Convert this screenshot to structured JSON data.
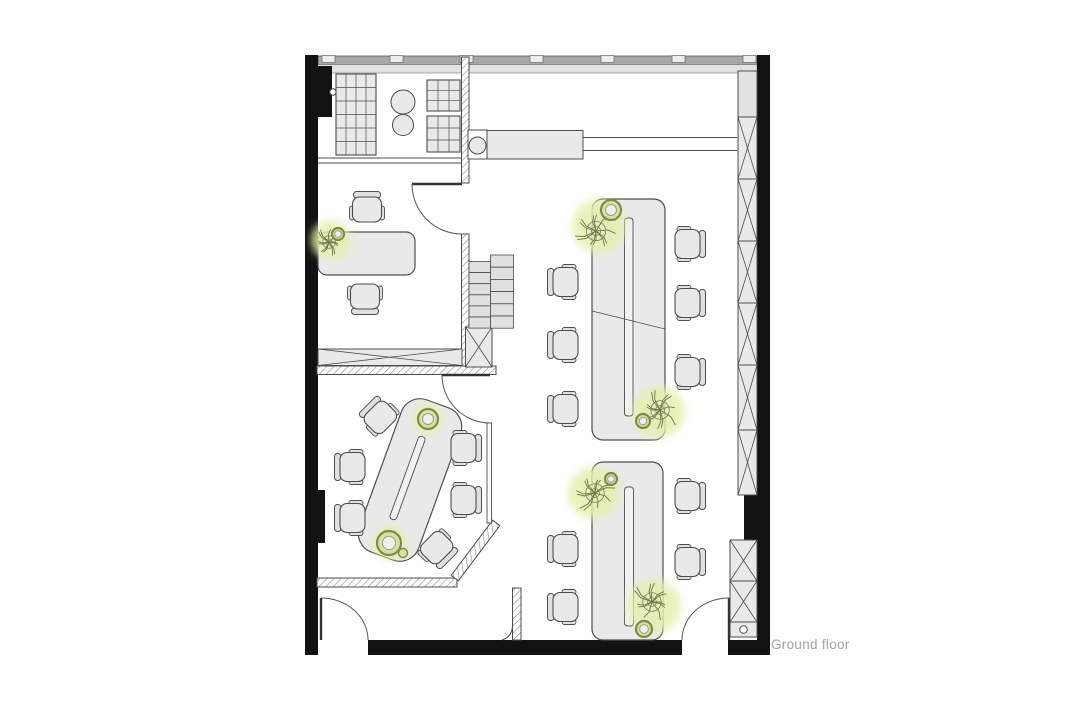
{
  "title": {
    "label": "Ground floor"
  },
  "colors": {
    "wall": "#121212",
    "stroke": "#4d4d4d",
    "furn": "#e9e9e9",
    "furn2": "#e0e0e0",
    "white": "#ffffff",
    "band_outer": "#a8a8a8",
    "band_inner": "#e2e2e2",
    "mullion": "#ececec",
    "hatch": "#8c8c8c",
    "glow": "#e4efad",
    "branch": "#6b7446",
    "pot_ring": "#7d8b49",
    "pot_fill": "#d7e39b",
    "pot_inner": "#f0efec",
    "label": "#a3a3a3"
  },
  "floorplan": {
    "window_band": {
      "outer": {
        "x": 318,
        "y": 56,
        "w": 439,
        "h": 8.5
      },
      "inner": {
        "x": 318,
        "y": 64.5,
        "w": 439,
        "h": 8.5
      },
      "mullions": [
        322,
        390,
        460,
        530,
        601,
        672,
        743
      ],
      "mullion_w": 13,
      "mullion_h": 7
    },
    "black_walls": [
      {
        "name": "wall-left",
        "x": 305,
        "y": 55,
        "w": 13,
        "h": 600
      },
      {
        "name": "wall-right",
        "x": 757,
        "y": 55,
        "w": 13,
        "h": 600
      },
      {
        "name": "wall-bottom-main",
        "x": 368,
        "y": 640,
        "w": 314,
        "h": 15
      },
      {
        "name": "wall-bottom-right",
        "x": 728,
        "y": 640,
        "w": 42,
        "h": 15
      },
      {
        "name": "column-top-left",
        "x": 316,
        "y": 66,
        "w": 16,
        "h": 51
      },
      {
        "name": "pier-left",
        "x": 305,
        "y": 490,
        "w": 20,
        "h": 53
      },
      {
        "name": "pier-right",
        "x": 744,
        "y": 495,
        "w": 26,
        "h": 45
      }
    ],
    "hatched_walls": [
      {
        "name": "wall-kitchen-partition",
        "x": 461.5,
        "y": 57,
        "w": 7.5,
        "h": 126
      },
      {
        "name": "wall-office-partition",
        "x": 461.5,
        "y": 234,
        "w": 7.5,
        "h": 140
      },
      {
        "name": "wall-office-bottom",
        "x": 317,
        "y": 366,
        "w": 179,
        "h": 8.5
      },
      {
        "name": "wall-meeting-bottom",
        "x": 317,
        "y": 578,
        "w": 140,
        "h": 9
      },
      {
        "name": "wall-meeting-chamfer",
        "x": 441,
        "y": 546,
        "w": 69,
        "h": 9,
        "rot": -53,
        "cx": 475.5,
        "cy": 550.5
      },
      {
        "name": "wall-entry-stub",
        "x": 512.5,
        "y": 588,
        "w": 8.5,
        "h": 52
      }
    ],
    "wall_paths": [
      {
        "name": "stub-foot-curve",
        "d": "M502,640 Q512,637 512.5,626"
      }
    ],
    "thin_walls": [
      {
        "name": "glass-partition",
        "x": 487,
        "y": 423,
        "w": 4.5,
        "h": 100
      }
    ],
    "xboxes": [
      {
        "name": "credenza",
        "x": 318,
        "y": 349,
        "w": 144,
        "h": 16.5
      },
      {
        "name": "shaft",
        "x": 465.5,
        "y": 327,
        "w": 26.5,
        "h": 40
      }
    ],
    "lattices": [
      {
        "name": "lattice-right-upper",
        "x": 738,
        "w": 19,
        "bounds": [
          117,
          179,
          241,
          303,
          365,
          430,
          495
        ]
      },
      {
        "name": "lattice-right-lower",
        "x": 730,
        "w": 27,
        "bounds": [
          540,
          581,
          622
        ]
      }
    ],
    "plain_rects": [
      {
        "name": "lattice-cap",
        "x": 738,
        "y": 71,
        "w": 19,
        "h": 46,
        "fill": "band_inner"
      },
      {
        "name": "drawer-box",
        "x": 730,
        "y": 622,
        "w": 27,
        "h": 15,
        "fill": "furn"
      },
      {
        "name": "counter-box",
        "x": 468,
        "y": 130,
        "w": 19,
        "h": 29,
        "fill": "white"
      },
      {
        "name": "counter",
        "x": 487,
        "y": 130.5,
        "w": 96,
        "h": 28.5,
        "fill": "furn"
      }
    ],
    "circles": [
      {
        "name": "counter-basin",
        "c": [
          477.5,
          145.5
        ],
        "r": 8.5,
        "fill": "furn"
      },
      {
        "name": "kitchen-stool-1",
        "c": [
          403,
          102
        ],
        "r": 12,
        "fill": "furn"
      },
      {
        "name": "kitchen-stool-2",
        "c": [
          403,
          125
        ],
        "r": 10.5,
        "fill": "furn"
      },
      {
        "name": "drawer-knob",
        "c": [
          743.5,
          629.5
        ],
        "r": 3.8,
        "fill": "white"
      },
      {
        "name": "column-fitting",
        "c": [
          333,
          92
        ],
        "r": 3.2,
        "fill": "white"
      }
    ],
    "lines": [
      {
        "name": "counter-rail-1",
        "p": [
          583,
          137.5,
          737,
          137.5
        ]
      },
      {
        "name": "counter-rail-2",
        "p": [
          583,
          150.5,
          737,
          150.5
        ]
      },
      {
        "name": "kitchen-wall-line-1",
        "p": [
          318,
          158,
          461,
          158
        ]
      },
      {
        "name": "kitchen-wall-line-2",
        "p": [
          318,
          163,
          461,
          163
        ]
      },
      {
        "name": "table1-divider",
        "p": [
          592,
          311,
          665,
          329
        ]
      }
    ],
    "grids": [
      {
        "name": "shelf-unit-left",
        "x": 336,
        "y": 74,
        "w": 40,
        "h": 81,
        "cols": 4,
        "rows": 6
      },
      {
        "name": "shelf-table-1",
        "x": 427,
        "y": 80,
        "w": 33,
        "h": 31,
        "cols": 3,
        "rows": 3
      },
      {
        "name": "shelf-table-2",
        "x": 427,
        "y": 116,
        "w": 33,
        "h": 36,
        "cols": 3,
        "rows": 3
      }
    ],
    "stairs": {
      "cols": [
        {
          "x": 490.5,
          "w": 23,
          "y0": 255,
          "n": 6,
          "h": 12.2
        },
        {
          "x": 469,
          "w": 21.5,
          "y0": 261.5,
          "n": 6,
          "h": 11.1
        }
      ]
    },
    "doors": [
      {
        "name": "door-kitchen",
        "leaf": [
          412,
          184,
          462,
          184
        ],
        "arc": "M412,184 A50,50 0 0 0 462,234"
      },
      {
        "name": "door-meeting",
        "leaf": [
          442,
          375,
          490,
          375
        ],
        "arc": "M442,375 A48,48 0 0 0 490,423"
      },
      {
        "name": "door-entry-left",
        "leaf": [
          321,
          598,
          321,
          640
        ],
        "arc": "M321,598 A47,42 0 0 1 368,640"
      },
      {
        "name": "door-entry-right",
        "leaf": [
          729,
          598,
          729,
          640
        ],
        "arc": "M729,598 A47,42 0 0 0 682,640"
      }
    ],
    "tables": [
      {
        "name": "office-desk",
        "x": 318,
        "y": 232,
        "w": 97,
        "h": 43,
        "rx": 9
      },
      {
        "name": "work-table-1",
        "x": 592,
        "y": 199,
        "w": 73,
        "h": 241,
        "rx": 11
      },
      {
        "name": "work-table-2",
        "x": 592,
        "y": 462,
        "w": 71,
        "h": 178,
        "rx": 11
      },
      {
        "name": "meeting-table",
        "x": 378.5,
        "y": 399,
        "w": 63,
        "h": 162,
        "rx": 20,
        "rot": 20,
        "cx": 410,
        "cy": 480
      }
    ],
    "slits": [
      {
        "name": "table1-tray",
        "x": 624.5,
        "y": 218,
        "w": 8.5,
        "h": 198,
        "rx": 3
      },
      {
        "name": "table2-tray",
        "x": 624.5,
        "y": 487,
        "w": 9,
        "h": 139,
        "rx": 3
      },
      {
        "name": "meeting-tray",
        "x": 404,
        "y": 434,
        "w": 7,
        "h": 88,
        "rx": 3,
        "rot": 20,
        "cx": 407.5,
        "cy": 478
      }
    ],
    "chairs": [
      [
        367,
        209,
        90
      ],
      [
        365,
        297,
        270
      ],
      [
        565,
        282,
        0
      ],
      [
        565,
        345,
        0
      ],
      [
        565,
        409,
        0
      ],
      [
        688,
        244,
        180
      ],
      [
        688,
        303,
        180
      ],
      [
        688,
        372,
        180
      ],
      [
        565,
        549,
        0
      ],
      [
        565,
        607,
        0
      ],
      [
        688,
        496,
        180
      ],
      [
        688,
        562,
        180
      ],
      [
        380,
        417,
        45
      ],
      [
        352,
        467,
        0
      ],
      [
        352,
        518,
        0
      ],
      [
        464,
        448,
        180
      ],
      [
        464,
        500,
        180
      ],
      [
        437,
        548,
        225
      ]
    ],
    "plants": [
      {
        "name": "plant-office-desk",
        "glow": [
          331,
          240,
          20
        ],
        "branches": [
          329,
          242,
          15
        ],
        "pots": [
          {
            "c": [
              338,
              234
            ],
            "r": 6,
            "ring": true
          }
        ]
      },
      {
        "name": "plant-table1-top",
        "glow": [
          599,
          226,
          27
        ],
        "branches": [
          596,
          231,
          23
        ],
        "pots": [
          {
            "c": [
              611,
              210
            ],
            "r": 10,
            "ring": true
          }
        ]
      },
      {
        "name": "plant-table1-bottom",
        "glow": [
          659,
          412,
          26
        ],
        "branches": [
          660,
          410,
          22
        ],
        "pots": [
          {
            "c": [
              643,
              421
            ],
            "r": 7,
            "ring": true
          }
        ]
      },
      {
        "name": "plant-table2-top",
        "glow": [
          594,
          493,
          26
        ],
        "branches": [
          595,
          493,
          22
        ],
        "pots": [
          {
            "c": [
              611,
              479
            ],
            "r": 6,
            "ring": true
          }
        ]
      },
      {
        "name": "plant-table2-bottom",
        "glow": [
          654,
          606,
          27
        ],
        "branches": [
          652,
          602,
          22
        ],
        "pots": [
          {
            "c": [
              644,
              629
            ],
            "r": 8,
            "ring": true
          }
        ]
      },
      {
        "name": "plant-meeting-top",
        "glow": [
          428,
          419,
          15
        ],
        "pots": [
          {
            "c": [
              428,
              419
            ],
            "r": 10,
            "ring": true
          }
        ]
      },
      {
        "name": "plant-meeting-bottom",
        "glow": [
          390,
          543,
          17
        ],
        "pots": [
          {
            "c": [
              389,
              543
            ],
            "r": 12,
            "ring": true
          },
          {
            "c": [
              403,
              553
            ],
            "r": 4.5,
            "ring": false
          }
        ]
      }
    ]
  }
}
